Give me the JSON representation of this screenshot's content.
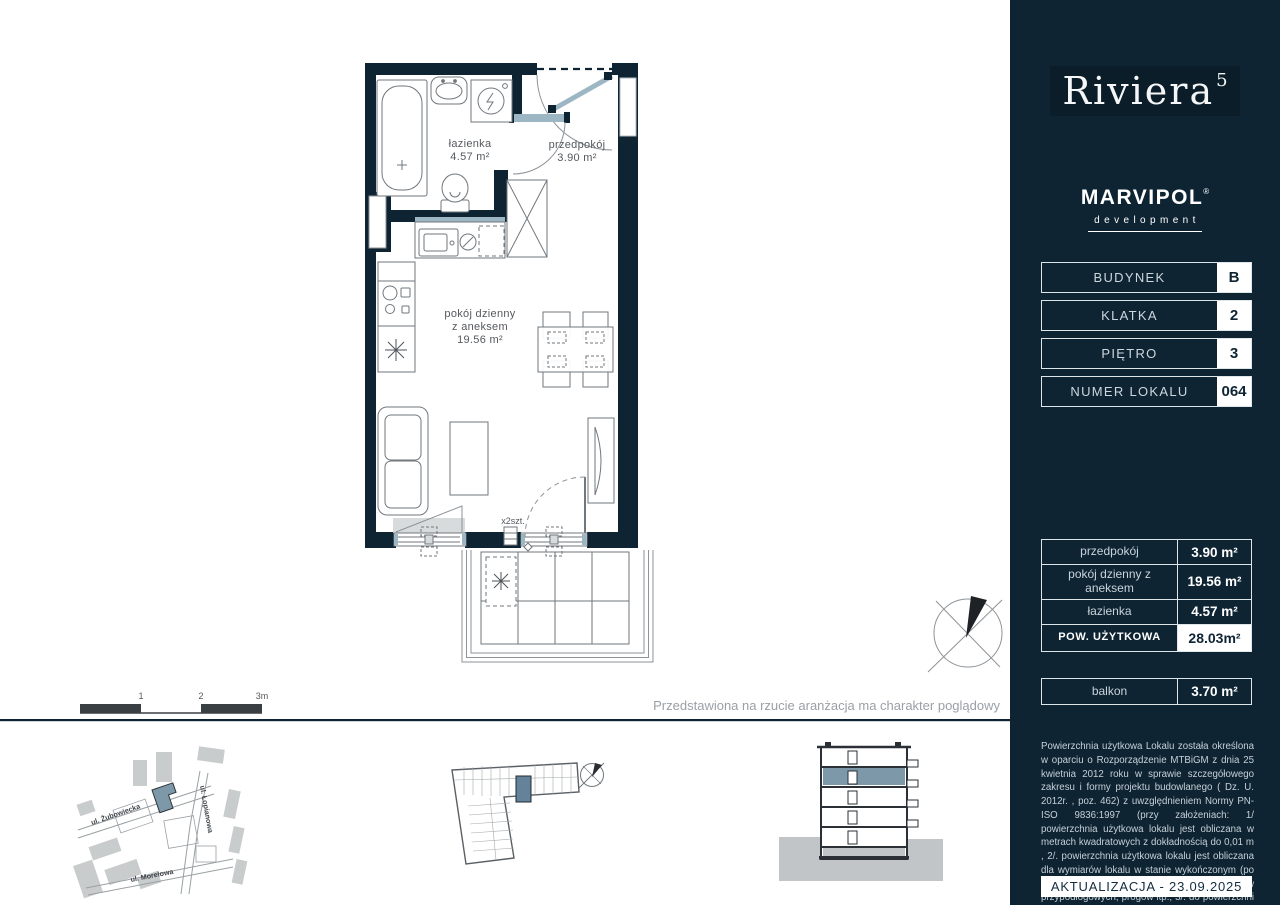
{
  "colors": {
    "navy": "#0e2433",
    "highlight": "#7d98a8",
    "accent_light": "#9db6c3"
  },
  "sidebar": {
    "logo": {
      "name": "Riviera",
      "sup": "5"
    },
    "developer": {
      "name": "MARVIPOL",
      "mark": "®",
      "tagline": "development"
    },
    "info_rows": [
      {
        "label": "BUDYNEK",
        "value": "B"
      },
      {
        "label": "KLATKA",
        "value": "2"
      },
      {
        "label": "PIĘTRO",
        "value": "3"
      },
      {
        "label": "NUMER LOKALU",
        "value": "064"
      }
    ],
    "area_table": [
      {
        "label": "przedpokój",
        "value": "3.90 m²"
      },
      {
        "label": "pokój dzienny z aneksem",
        "value": "19.56 m²"
      },
      {
        "label": "łazienka",
        "value": "4.57 m²"
      }
    ],
    "total_row": {
      "label": "POW. UŻYTKOWA",
      "value": "28.03m²"
    },
    "balcony_row": {
      "label": "balkon",
      "value": "3.70 m²"
    },
    "legal_text": "Powierzchnia użytkowa Lokalu została określona w oparciu o Rozporządzenie MTBiGM z dnia 25 kwietnia 2012 roku w sprawie szczegółowego zakresu i formy projektu budowlanego ( Dz. U. 2012r. , poz. 462) z uwzględnieniem Normy PN-ISO 9836:1997 (przy założeniach: 1/ powierzchnia użytkowa lokalu jest obliczana w metrach kwadratowych z dokładnością do 0,01 m , 2/. powierzchnia użytkowa lokalu jest obliczana dla wymiarów lokalu w stanie wykończonym (po tynkach), na poziomie podłogi, nie licząc listew przypodłogowych, progów itp.; 3/. do powierzchni użytkowej lokalu nie wlicza się: powierzchni otworów na drzwi i okna;",
    "update_label": "AKTUALIZACJA - 23.09.2025"
  },
  "plan": {
    "rooms": {
      "bathroom": {
        "name": "łazienka",
        "area": "4.57 m²"
      },
      "hall": {
        "name": "przedpokój",
        "area": "3.90 m²"
      },
      "living": {
        "name": "pokój dzienny",
        "name2": "z aneksem",
        "area": "19.56 m²"
      }
    },
    "window_count_label": "x2szt.",
    "disclaimer": "Przedstawiona na rzucie aranżacja ma charakter poglądowy",
    "scale_ticks": [
      "1",
      "2",
      "3m"
    ]
  },
  "site_map": {
    "streets": [
      "ul. Żubowiecka",
      "ul. Łopianowa",
      "ul. Morelowa"
    ]
  }
}
